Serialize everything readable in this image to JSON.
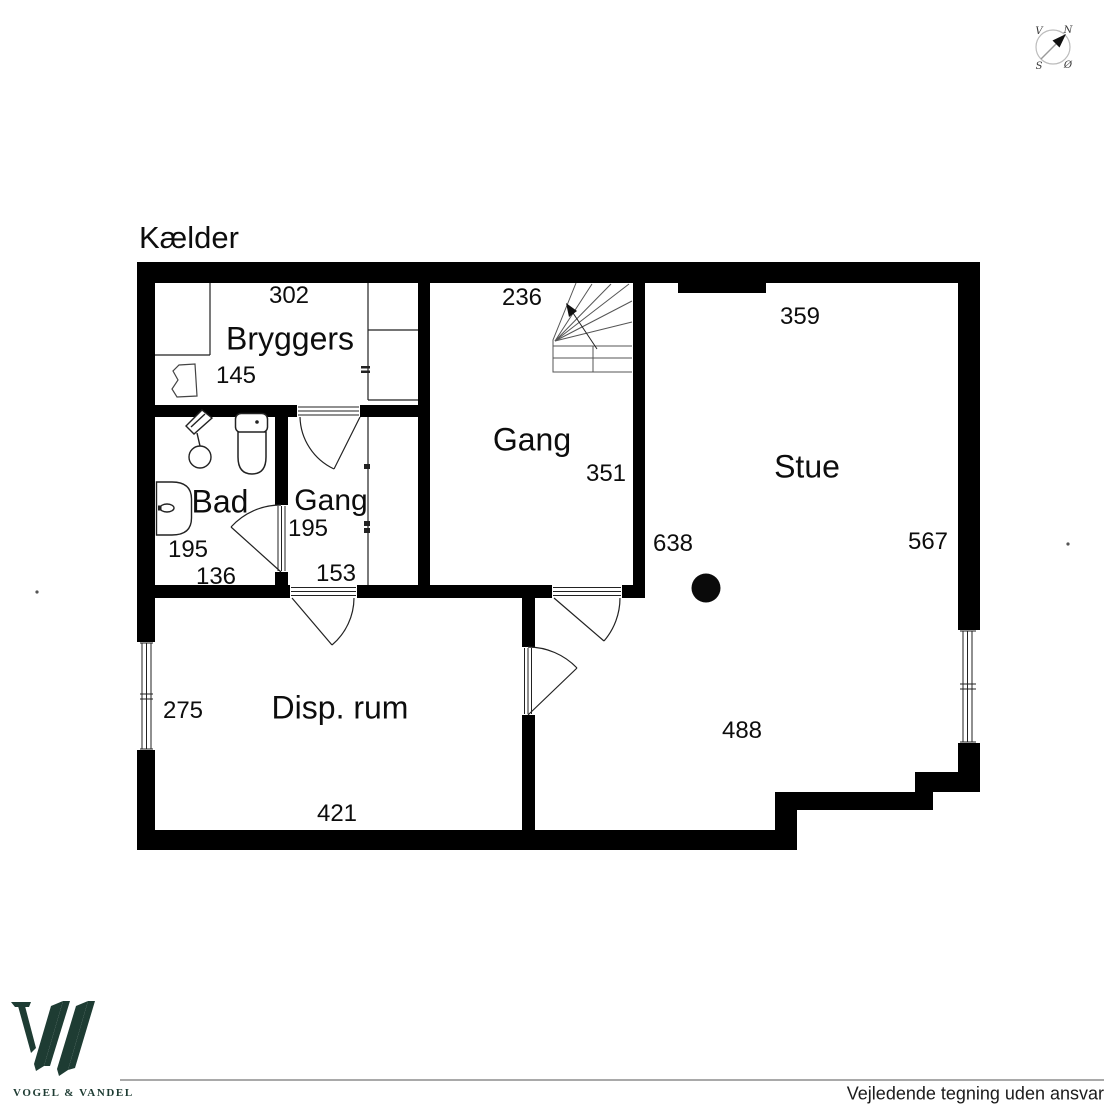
{
  "title": "Kælder",
  "compass": {
    "nw": "V",
    "ne": "N",
    "sw": "S",
    "se": "Ø"
  },
  "rooms": {
    "bryggers": {
      "label": "Bryggers",
      "width": "302",
      "depth": "145"
    },
    "gang_hall": {
      "label": "Gang",
      "width": "236",
      "depth": "351"
    },
    "stue": {
      "label": "Stue",
      "width_top": "359",
      "width_bottom": "488",
      "depth": "567",
      "depth_left": "638"
    },
    "bad": {
      "label": "Bad",
      "width": "136",
      "depth": "195"
    },
    "gang_small": {
      "label": "Gang",
      "width": "153",
      "depth": "195"
    },
    "disp_rum": {
      "label": "Disp. rum",
      "width": "421",
      "depth": "275"
    }
  },
  "footer": {
    "brand": "VOGEL & VANDEL",
    "disclaimer": "Vejledende tegning uden ansvar"
  },
  "colors": {
    "wall": "#000000",
    "logo_green": "#1e3c33",
    "divider_gray": "#a9a9a9"
  }
}
